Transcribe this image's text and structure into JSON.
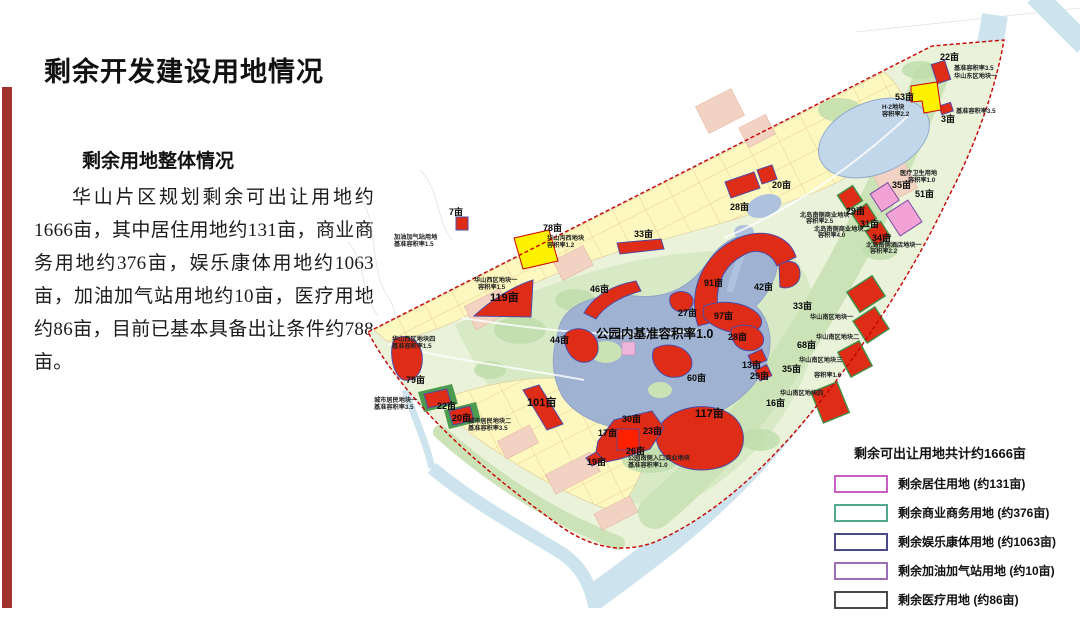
{
  "slide": {
    "title": "剩余开发建设用地情况",
    "section_heading": "剩余用地整体情况",
    "paragraph": "华山片区规划剩余可出让用地约1666亩，其中居住用地约131亩，商业商务用地约376亩，娱乐康体用地约1063亩，加油加气站用地约10亩，医疗用地约86亩，目前已基本具备出让条件约788亩。",
    "accent_color": "#A1342F"
  },
  "map": {
    "center_note": "公园内基准容积率1.0",
    "colors": {
      "parcel_red": "#DF2C17",
      "parcel_yellow": "#FFF200",
      "parcel_pink": "#F2A2D4",
      "boundary": "#C80000",
      "water": "#9FB2D2"
    },
    "labels": {
      "ne22": "22亩",
      "ne53": "53亩",
      "ne3": "3亩",
      "n20": "20亩",
      "n28": "28亩",
      "mid33": "33亩",
      "w78": "78亩",
      "w7": "7亩",
      "w119": "119亩",
      "w79": "79亩",
      "c46": "46亩",
      "c27": "27亩",
      "c91": "91亩",
      "c42": "42亩",
      "c97": "97亩",
      "s28": "28亩",
      "c44": "44亩",
      "c60": "60亩",
      "c13": "13亩",
      "c29": "29亩",
      "se33": "33亩",
      "se68": "68亩",
      "se35": "35亩",
      "se16": "16亩",
      "s117": "117亩",
      "s30": "30亩",
      "s17": "17亩",
      "s23": "23亩",
      "s26": "26亩",
      "s19": "19亩",
      "sw22": "22亩",
      "sw20": "20亩",
      "sw101": "101亩",
      "ne29": "29亩",
      "ne31": "31亩",
      "ne34": "34亩",
      "med35": "35亩",
      "med51": "51亩"
    },
    "annotations": {
      "east_far": "基准容积率3.5",
      "east_block": "华山东区地块一",
      "h2_block": "H-2地块",
      "h2_far": "容积率2.2",
      "ne3_far": "基准容积率3.5",
      "w78_block": "华山沟西地块",
      "w78_far": "容积率1.2",
      "gas_use": "加油加气站用地",
      "gas_far": "基准容积率1.5",
      "w119_block": "华山西区地块一",
      "w119_far": "容积率1.5",
      "w79_block": "华山西区地块四",
      "w79_far": "基准容积率1.5",
      "res1_block": "城市居民地块一",
      "res1_far": "基准容积率3.5",
      "res2_block": "城市居民地块二",
      "res2_far": "基准容积率3.5",
      "park_entry": "公园南侧入口商业地块",
      "park_entry_far": "基准容积率1.0",
      "se1_block": "华山南区地块一",
      "se2_block": "华山南区地块二",
      "se3_block": "华山南区地块三",
      "se3_far": "容积率1.6",
      "se4_block": "华山南区地块四",
      "biz1_block": "北岛南侧商业地块一",
      "biz1_far": "容积率2.5",
      "biz2_block": "北岛南侧商业地块二",
      "biz2_far": "容积率4.0",
      "hotel_block": "北岛南侧酒店地块一",
      "hotel_far": "容积率2.2",
      "med_use": "医疗卫生用地",
      "med_far": "容积率1.0"
    }
  },
  "legend": {
    "title": "剩余可出让用地共计约1666亩",
    "items": [
      {
        "label": "剩余居住用地 (约131亩)",
        "color": "#C95FC2"
      },
      {
        "label": "剩余商业商务用地 (约376亩)",
        "color": "#53A88F"
      },
      {
        "label": "剩余娱乐康体用地 (约1063亩)",
        "color": "#4A4A85"
      },
      {
        "label": "剩余加油加气站用地 (约10亩)",
        "color": "#9B6FB5"
      },
      {
        "label": "剩余医疗用地 (约86亩)",
        "color": "#4A4A4A"
      }
    ]
  }
}
